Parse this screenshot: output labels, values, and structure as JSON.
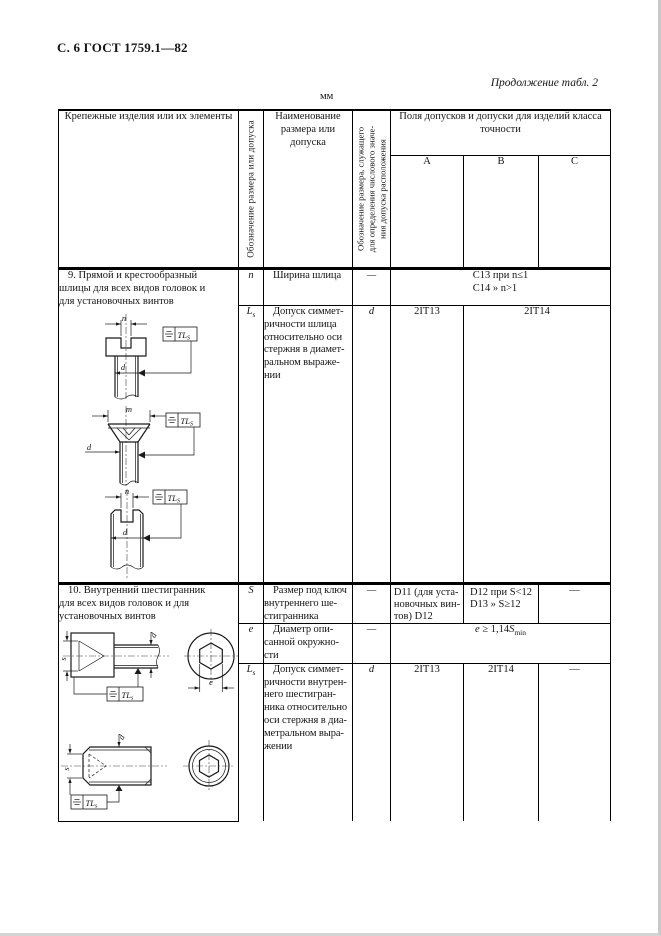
{
  "page": {
    "header": "С. 6 ГОСТ 1759.1—82",
    "continuation": "Продолжение табл. 2",
    "units": "мм"
  },
  "thead": {
    "fasteners": "Крепежные изделия или их элементы",
    "designation_vertical": "Обозначение размера или допуска",
    "name": "Наименование\nразмера или\nдопуска",
    "ref_vertical": "Обозначение размера, служащего\nдля определения числового значе-\nния допуска расположения",
    "fields_title": "Поля допусков и допуски для изделий класса\nточности",
    "class_a": "А",
    "class_b": "В",
    "class_c": "С"
  },
  "row9": {
    "item": "9. Прямой и крестообразный\nшлицы для всех видов головок и\nдля установочных винтов",
    "n_sym": "n",
    "n_name": "Ширина шлица",
    "n_ref": "—",
    "n_value": "C13 при n≤1\nC14   »   n>1",
    "ls_sym_main": "L",
    "ls_sym_sub": "s",
    "ls_name": "Допуск симмет-\nричности шлица\nотносительно оси\nстержня в диамет-\nральном выраже-\nнии",
    "ls_ref": "d",
    "ls_a": "2IT13",
    "ls_bc": "2IT14"
  },
  "row10": {
    "item": "10. Внутренний шестигранник\nдля всех видов головок и для\nустановочных винтов",
    "s_sym": "S",
    "s_name": "Размер под ключ\nвнутреннего ше-\nстигранника",
    "s_ref": "—",
    "s_a": "D11 (для уста-\nновочных вин-\nтов) D12",
    "s_b": "D12 при S<12\nD13   »   S≥12",
    "s_c": "—",
    "e_sym": "e",
    "e_name": "Диаметр опи-\nсанной окружно-\nсти",
    "e_ref": "—",
    "e_val_var1": "e",
    "e_val_mid": " ≥ 1,14",
    "e_val_var2": "S",
    "e_val_sub": "min",
    "ls_sym_main": "L",
    "ls_sym_sub": "s",
    "ls_name": "Допуск симмет-\nричности внутрен-\nнего шестигран-\nника относительно\nоси стержня в диа-\nметральном выра-\nжении",
    "ls_ref": "d",
    "ls_a": "2IT13",
    "ls_b": "2IT14",
    "ls_c": "—"
  },
  "drawings": {
    "dim_n": "n",
    "dim_m": "m",
    "dim_d": "d",
    "dim_s": "s",
    "dim_e": "e",
    "frame_main": "TL",
    "frame_sub_upper": "S",
    "frame_sub_lower": "s"
  }
}
